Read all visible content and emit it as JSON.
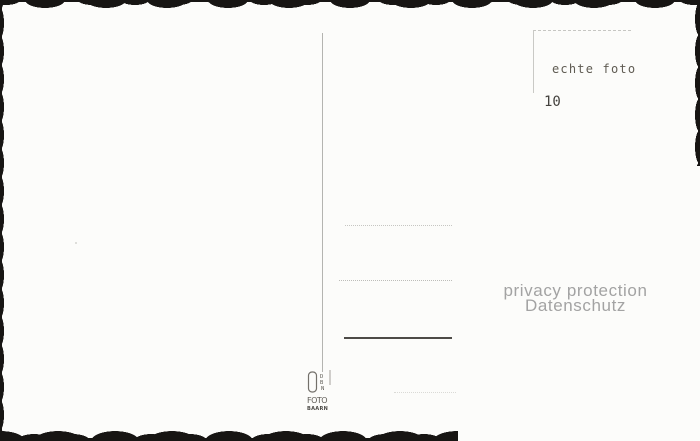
{
  "postcard_back": {
    "stamp_area": {
      "real_photo_label": "echte foto",
      "number": "10"
    },
    "privacy_watermark": {
      "line1": "privacy protection",
      "line2": "Datenschutz"
    },
    "publisher_logo": {
      "letter1": "D",
      "letter2": "B",
      "letter3": "N",
      "word": "FOTO",
      "city": "BAARN"
    },
    "colors": {
      "paper": "#fcfcfa",
      "deckle_edge": "#171513",
      "divider_line": "#b4b4b0",
      "stamp_box_line": "#c6c6c2",
      "dotted_address_line": "#c2c2be",
      "solid_address_line": "#4d4b47",
      "stamp_text": "#5f5b52",
      "watermark_text": "#a3a3a3"
    }
  }
}
